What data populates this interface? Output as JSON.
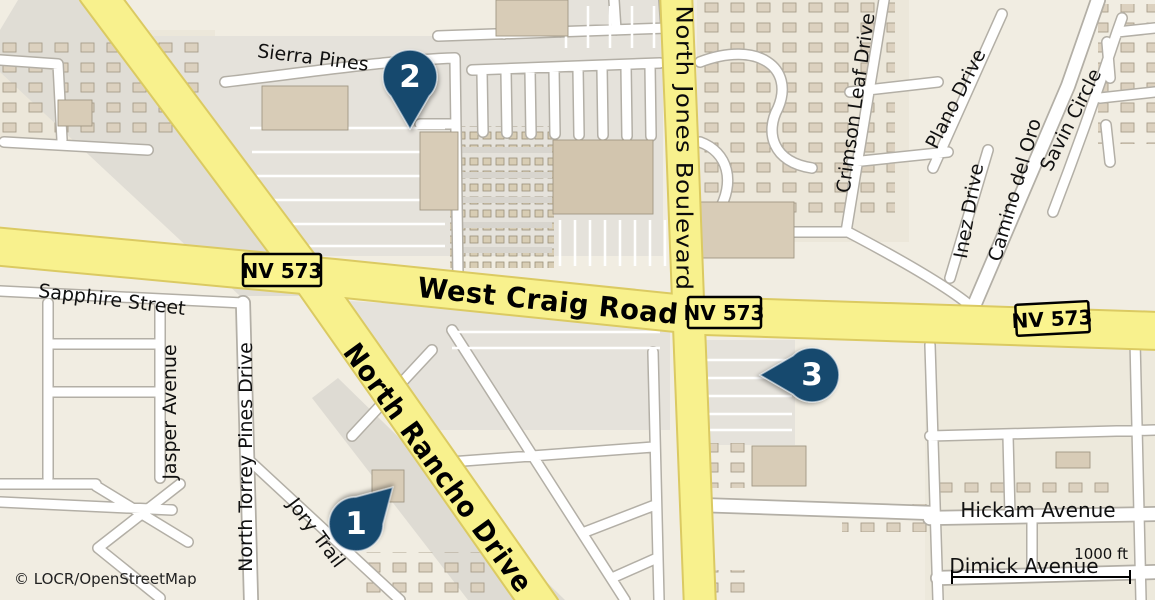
{
  "map": {
    "attribution": "© LOCR/OpenStreetMap",
    "scale_bar_label": "1000 ft",
    "major_roads": [
      {
        "name": "West Craig Road"
      },
      {
        "name": "North Jones Boulevard"
      },
      {
        "name": "North Rancho Drive"
      }
    ],
    "shields": [
      {
        "label": "NV 573"
      },
      {
        "label": "NV 573"
      },
      {
        "label": "NV 573"
      }
    ],
    "streets": [
      {
        "name": "Sierra Pines"
      },
      {
        "name": "Sapphire Street"
      },
      {
        "name": "Jasper Avenue"
      },
      {
        "name": "North Torrey Pines Drive"
      },
      {
        "name": "Jory Trail"
      },
      {
        "name": "Crimson Leaf Drive"
      },
      {
        "name": "Plano Drive"
      },
      {
        "name": "Inez Drive"
      },
      {
        "name": "Camino del Oro"
      },
      {
        "name": "Savin Circle"
      },
      {
        "name": "Hickam Avenue"
      },
      {
        "name": "Dimick Avenue"
      }
    ],
    "markers": [
      {
        "number": "1"
      },
      {
        "number": "2"
      },
      {
        "number": "3"
      }
    ],
    "colors": {
      "background": "#F1EDE2",
      "residential_tint": "#ECE7DA",
      "parking_gray": "#E5E2DB",
      "road_major_fill": "#F8F18D",
      "road_major_casing": "#DBCA62",
      "road_minor_fill": "#FFFFFF",
      "road_minor_casing": "#B3AFA6",
      "building_fill": "#D8CCB7",
      "marker_fill": "#17486E",
      "marker_text": "#FFFFFF",
      "shield_fill": "#FBF48E",
      "shield_border": "#000000",
      "label_text": "#111111"
    }
  }
}
